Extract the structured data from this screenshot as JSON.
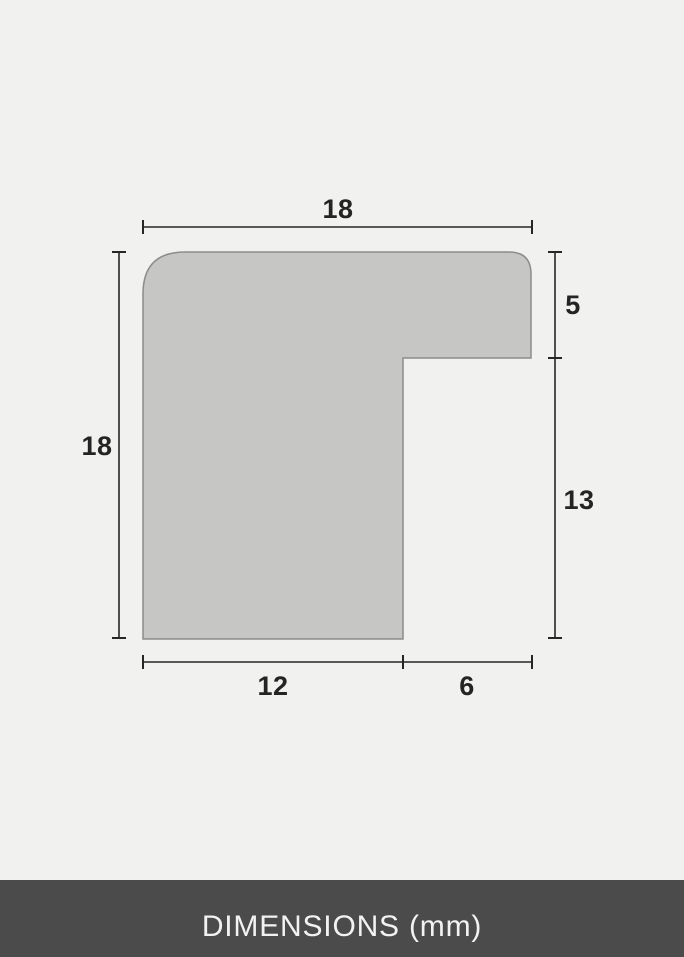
{
  "diagram": {
    "description": "frame-moulding-profile-cross-section",
    "unit": "mm",
    "labels": {
      "total_width": "18",
      "total_height": "18",
      "lip_height": "5",
      "rabbet_height": "13",
      "base_width": "12",
      "rabbet_width": "6"
    }
  },
  "footer": {
    "label": "DIMENSIONS (mm)"
  },
  "colors": {
    "background": "#f1f1ef",
    "shape_fill": "#c6c6c4",
    "shape_stroke": "#8c8c8c",
    "dimension_line": "#262626",
    "label_text": "#242424",
    "footer_background": "#4b4b4b",
    "footer_text": "#f2f2f2"
  }
}
